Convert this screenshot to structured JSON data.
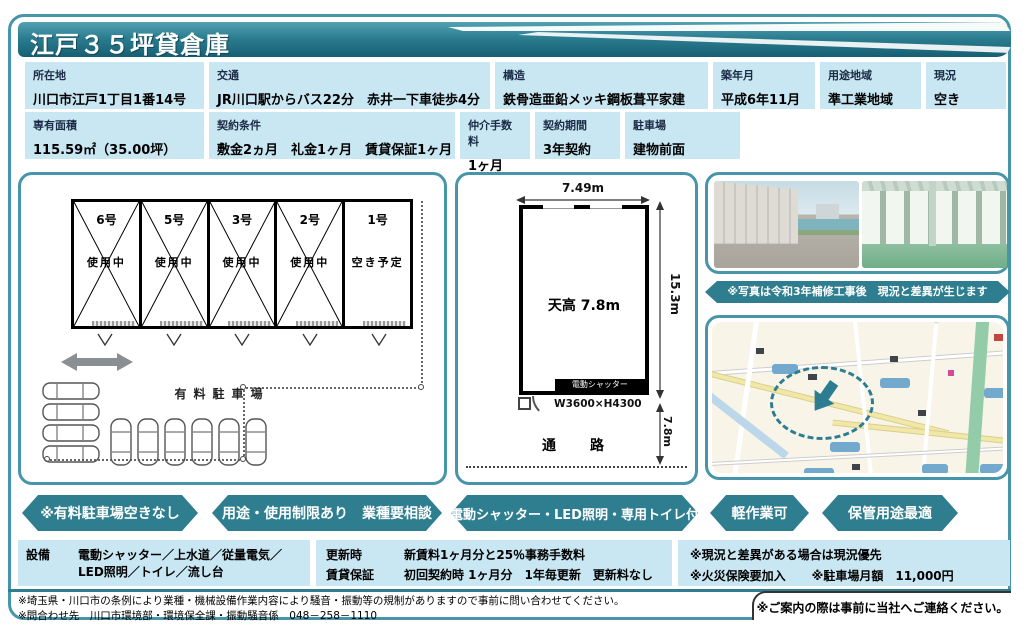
{
  "title": "江戸３５坪貸倉庫",
  "colors": {
    "accent": "#2e7e90",
    "cell_blue": "#c8e7f3",
    "frame_teal": "#4795a8"
  },
  "info": {
    "row1": [
      {
        "label": "所在地",
        "value": "川口市江戸1丁目1番14号"
      },
      {
        "label": "交通",
        "value": "JR川口駅からバス22分　赤井一下車徒歩4分"
      },
      {
        "label": "構造",
        "value": "鉄骨造亜鉛メッキ鋼板葺平家建"
      },
      {
        "label": "築年月",
        "value": "平成6年11月"
      },
      {
        "label": "用途地域",
        "value": "準工業地域"
      },
      {
        "label": "現況",
        "value": "空き"
      }
    ],
    "row2": [
      {
        "label": "専有面積",
        "value": "115.59㎡（35.00坪）"
      },
      {
        "label": "契約条件",
        "value": "敷金2ヵ月　礼金1ヶ月　賃貸保証1ヶ月"
      },
      {
        "label": "仲介手数料",
        "value": "1ヶ月"
      },
      {
        "label": "契約期間",
        "value": "3年契約"
      },
      {
        "label": "駐車場",
        "value": "建物前面"
      }
    ]
  },
  "site_plan": {
    "units": [
      {
        "name": "6号",
        "status": "使用中",
        "occupied": true
      },
      {
        "name": "5号",
        "status": "使用中",
        "occupied": true
      },
      {
        "name": "3号",
        "status": "使用中",
        "occupied": true
      },
      {
        "name": "2号",
        "status": "使用中",
        "occupied": true
      },
      {
        "name": "1号",
        "status": "空き予定",
        "occupied": false
      }
    ],
    "parking_label": "有料駐車場"
  },
  "unit_plan": {
    "width_label": "7.49m",
    "depth_label": "15.3m",
    "ceiling_label": "天高 7.8m",
    "shutter_label": "電動シャッター",
    "shutter_size": "W3600×H4300",
    "front_label": "7.8m",
    "road_label": "通　路"
  },
  "photos": {
    "note": "※写真は令和3年補修工事後　現況と差異が生じます"
  },
  "banners": {
    "items": [
      "※有料駐車場空きなし",
      "用途・使用制限あり　業種要相談",
      "電動シャッター・LED照明・専用トイレ付",
      "軽作業可",
      "保管用途最適"
    ]
  },
  "equipment": {
    "label": "設備",
    "line1": "電動シャッター／上水道／従量電気／",
    "line2": "LED照明／トイレ／流し台"
  },
  "renewal": {
    "label1": "更新時",
    "value1": "新賃料1ヶ月分と25％事務手数料",
    "label2": "賃貸保証",
    "value2": "初回契約時 1ヶ月分　1年毎更新　更新料なし"
  },
  "notes": {
    "line1": "※現況と差異がある場合は現況優先",
    "line2a": "※火災保険要加入",
    "line2b": "※駐車場月額　11,000円"
  },
  "footer": {
    "line1": "※埼玉県・川口市の条例により業種・機械設備作業内容により騒音・振動等の規制がありますので事前に問い合わせてください。",
    "line2": "※問合わせ先　川口市環境部・環境保全課・振動騒音係　048－258－1110",
    "right": "※ご案内の際は事前に当社へご連絡ください。"
  }
}
